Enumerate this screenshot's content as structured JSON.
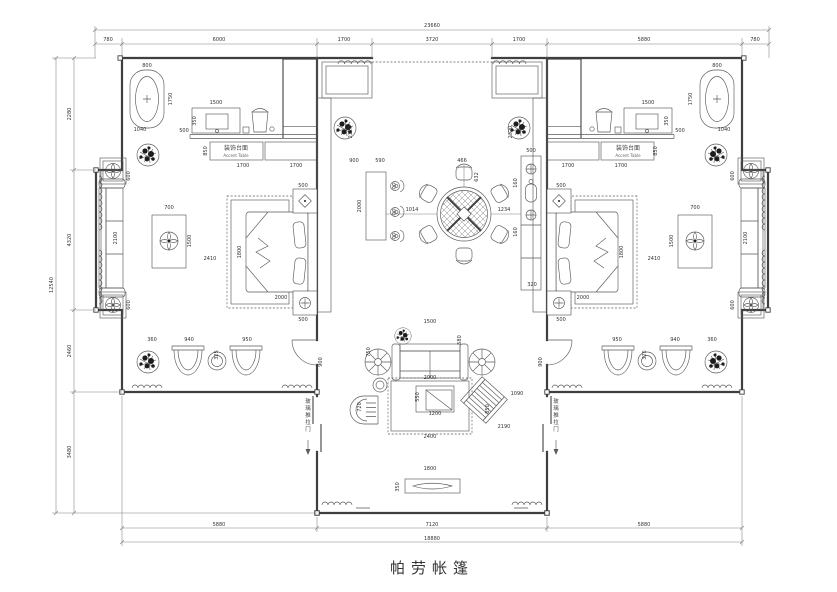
{
  "meta": {
    "title": "帕劳帐篷",
    "ink": "#3f3f3f",
    "background": "#ffffff"
  },
  "labels": [
    {
      "x": 432,
      "y": 573,
      "t": "帕劳帐篷",
      "cls": "title",
      "n": "plan-title"
    },
    {
      "x": 236,
      "y": 150,
      "t": "装饰台面",
      "cls": "cn",
      "n": "accent-table-label-cn-left"
    },
    {
      "x": 236,
      "y": 157,
      "t": "Accent Table",
      "cls": "en",
      "n": "accent-table-label-en-left"
    },
    {
      "x": 628,
      "y": 150,
      "t": "装饰台面",
      "cls": "cn",
      "n": "accent-table-label-cn-right"
    },
    {
      "x": 628,
      "y": 157,
      "t": "Accent Table",
      "cls": "en",
      "n": "accent-table-label-en-right"
    }
  ],
  "vlabels": [
    {
      "x": 308,
      "y": 403,
      "t": "玻璃推拉门",
      "n": "sliding-door-label-left"
    },
    {
      "x": 556,
      "y": 403,
      "t": "玻璃推拉门",
      "n": "sliding-door-label-right"
    }
  ],
  "dims": [
    {
      "x": 432,
      "y": 27,
      "t": "23660"
    },
    {
      "x": 108,
      "y": 41,
      "t": "780"
    },
    {
      "x": 219,
      "y": 41,
      "t": "6000"
    },
    {
      "x": 344,
      "y": 41,
      "t": "1700"
    },
    {
      "x": 432,
      "y": 41,
      "t": "3720"
    },
    {
      "x": 519,
      "y": 41,
      "t": "1700"
    },
    {
      "x": 644,
      "y": 41,
      "t": "5880"
    },
    {
      "x": 755,
      "y": 41,
      "t": "780"
    },
    {
      "x": 219,
      "y": 526,
      "t": "5880"
    },
    {
      "x": 432,
      "y": 526,
      "t": "7120"
    },
    {
      "x": 644,
      "y": 526,
      "t": "5880"
    },
    {
      "x": 432,
      "y": 540,
      "t": "18880"
    },
    {
      "x": 71,
      "y": 114,
      "t": "2280",
      "r": 1
    },
    {
      "x": 71,
      "y": 240,
      "t": "4320",
      "r": 1
    },
    {
      "x": 71,
      "y": 351,
      "t": "2460",
      "r": 1
    },
    {
      "x": 71,
      "y": 452,
      "t": "3480",
      "r": 1
    },
    {
      "x": 53,
      "y": 285,
      "t": "12540",
      "r": 1
    },
    {
      "x": 147,
      "y": 67,
      "t": "800",
      "m": 1
    },
    {
      "x": 172,
      "y": 99,
      "t": "1750",
      "r": 1,
      "m": 1
    },
    {
      "x": 140,
      "y": 131,
      "t": "1040",
      "m": 1
    },
    {
      "x": 216,
      "y": 104,
      "t": "1500",
      "m": 1
    },
    {
      "x": 196,
      "y": 121,
      "t": "350",
      "r": 1,
      "m": 1
    },
    {
      "x": 184,
      "y": 132,
      "t": "500",
      "m": 1
    },
    {
      "x": 207,
      "y": 151,
      "t": "850",
      "r": 1,
      "m": 1
    },
    {
      "x": 243,
      "y": 167,
      "t": "1700",
      "m": 1
    },
    {
      "x": 296,
      "y": 167,
      "t": "1700",
      "m": 1
    },
    {
      "x": 303,
      "y": 187,
      "t": "500",
      "m": 1
    },
    {
      "x": 210,
      "y": 260,
      "t": "2410",
      "m": 1
    },
    {
      "x": 241,
      "y": 252,
      "t": "1800",
      "r": 1,
      "m": 1
    },
    {
      "x": 281,
      "y": 299,
      "t": "2000",
      "m": 1
    },
    {
      "x": 303,
      "y": 321,
      "t": "500",
      "m": 1
    },
    {
      "x": 130,
      "y": 176,
      "t": "600",
      "r": 1,
      "m": 1
    },
    {
      "x": 117,
      "y": 238,
      "t": "2100",
      "r": 1,
      "m": 1
    },
    {
      "x": 130,
      "y": 305,
      "t": "600",
      "r": 1,
      "m": 1
    },
    {
      "x": 169,
      "y": 209,
      "t": "700",
      "m": 1
    },
    {
      "x": 191,
      "y": 241,
      "t": "1500",
      "r": 1,
      "m": 1
    },
    {
      "x": 152,
      "y": 341,
      "t": "360",
      "m": 1
    },
    {
      "x": 189,
      "y": 341,
      "t": "940",
      "m": 1
    },
    {
      "x": 218,
      "y": 355,
      "t": "325",
      "r": 1,
      "m": 1
    },
    {
      "x": 247,
      "y": 341,
      "t": "950",
      "m": 1
    },
    {
      "x": 322,
      "y": 362,
      "t": "900",
      "r": 1,
      "m": 1
    },
    {
      "x": 352,
      "y": 132,
      "t": "2320",
      "r": 1,
      "m": 1
    },
    {
      "x": 354,
      "y": 162,
      "t": "900"
    },
    {
      "x": 380,
      "y": 162,
      "t": "590"
    },
    {
      "x": 361,
      "y": 206,
      "t": "2000",
      "r": 1
    },
    {
      "x": 412,
      "y": 211,
      "t": "1014"
    },
    {
      "x": 504,
      "y": 211,
      "t": "1234"
    },
    {
      "x": 462,
      "y": 162,
      "t": "466"
    },
    {
      "x": 478,
      "y": 177,
      "t": "632",
      "r": 1
    },
    {
      "x": 531,
      "y": 152,
      "t": "500"
    },
    {
      "x": 517,
      "y": 183,
      "t": "160",
      "r": 1
    },
    {
      "x": 517,
      "y": 232,
      "t": "160",
      "r": 1
    },
    {
      "x": 532,
      "y": 286,
      "t": "320"
    },
    {
      "x": 430,
      "y": 323,
      "t": "1500"
    },
    {
      "x": 461,
      "y": 340,
      "t": "580",
      "r": 1
    },
    {
      "x": 370,
      "y": 352,
      "t": "750",
      "r": 1
    },
    {
      "x": 430,
      "y": 379,
      "t": "2000"
    },
    {
      "x": 419,
      "y": 397,
      "t": "550",
      "r": 1
    },
    {
      "x": 435,
      "y": 415,
      "t": "1200"
    },
    {
      "x": 489,
      "y": 409,
      "t": "850",
      "r": 1
    },
    {
      "x": 517,
      "y": 395,
      "t": "1090"
    },
    {
      "x": 504,
      "y": 428,
      "t": "2190"
    },
    {
      "x": 430,
      "y": 438,
      "t": "2400"
    },
    {
      "x": 361,
      "y": 407,
      "t": "720",
      "r": 1
    },
    {
      "x": 430,
      "y": 470,
      "t": "1800"
    },
    {
      "x": 399,
      "y": 487,
      "t": "350",
      "r": 1
    }
  ]
}
